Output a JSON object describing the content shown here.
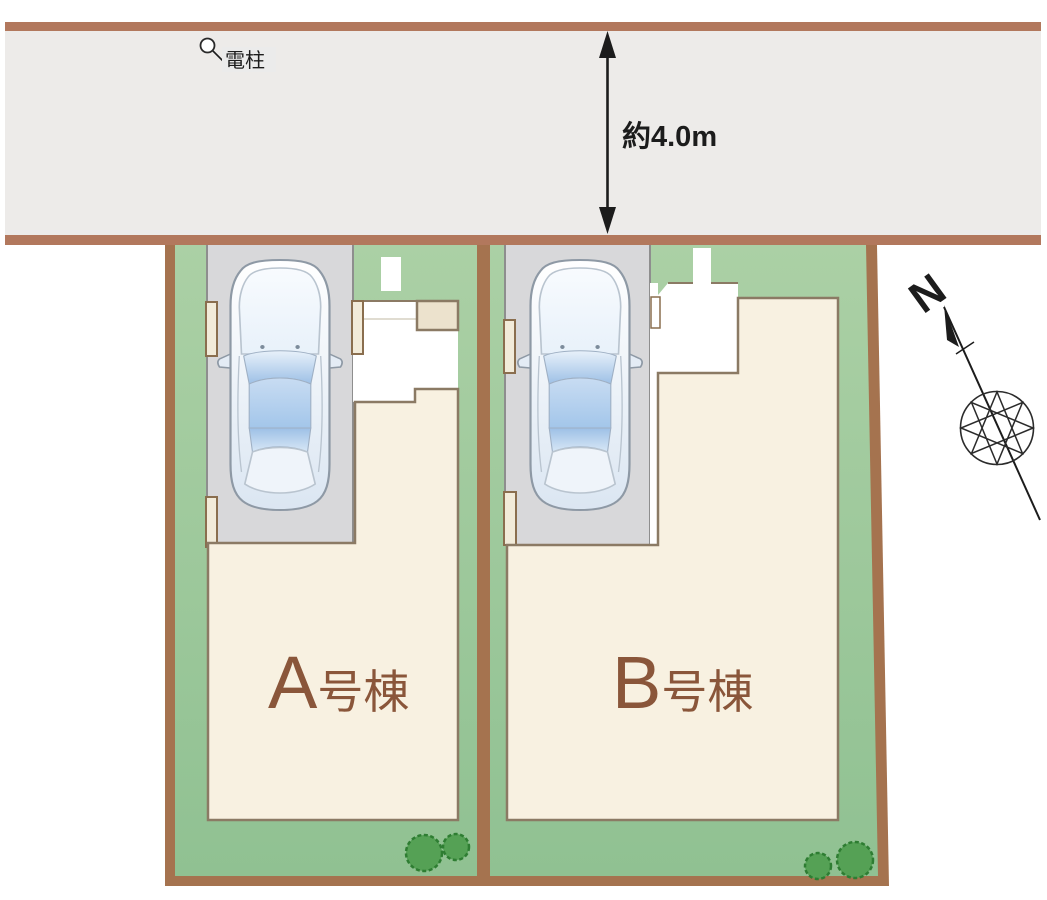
{
  "scene": {
    "type": "residential-site-plan",
    "lot_count": 2
  },
  "road": {
    "width_label": "約4.0m",
    "utility_pole_label": "電柱"
  },
  "lots": [
    {
      "id": "A",
      "label": "A号棟",
      "label_letter": "A",
      "label_suffix": "号棟"
    },
    {
      "id": "B",
      "label": "B号棟",
      "label_letter": "B",
      "label_suffix": "号棟"
    }
  ],
  "compass": {
    "north_label": "N"
  },
  "icons": {
    "utility_pole": "utility-pole-icon",
    "compass_rose": "compass-rose-icon",
    "dimension_arrow": "vertical-double-arrow-icon",
    "tree": "tree-icon",
    "car": "car-top-view-icon"
  },
  "colors": {
    "road_fill": "#edebe9",
    "road_border": "#b2785d",
    "lot_border": "#a5734f",
    "grass": "#90c192",
    "grass_light": "#abd0a5",
    "parking": "#d8d8da",
    "parking_outline": "#8e8e8e",
    "building_fill": "#f8f1e1",
    "building_outline": "#8b7a64",
    "wall_fill": "#f2ebd9",
    "wall_outline": "#8a6e4e",
    "step_fill": "#ece2cd",
    "porch_fill": "#ffffff",
    "tree_fill": "#55a155",
    "tree_outline": "#2e7d32",
    "label_color": "#8a563a",
    "ink": "#1c1c1c",
    "car_outline": "#8e99a5",
    "car_glass": "#9dc0e6",
    "car_glass_light": "#e8f1fa"
  }
}
